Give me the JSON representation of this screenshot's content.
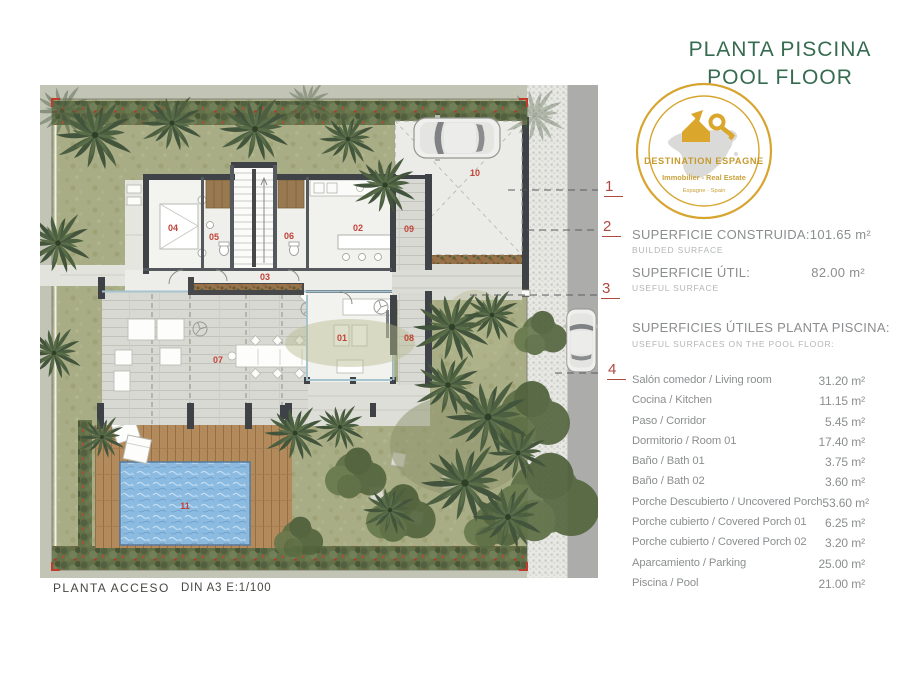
{
  "title": {
    "line1": "PLANTA PISCINA",
    "line2": "POOL FLOOR"
  },
  "logo": {
    "brand": "DESTINATION ESPAGNE",
    "tagline": "Immobilier - Real Estate",
    "subline": "Espagne - Spain"
  },
  "legend": {
    "markers": [
      {
        "n": "1"
      },
      {
        "n": "2"
      },
      {
        "n": "3"
      },
      {
        "n": "4"
      }
    ],
    "built_label": "SUPERFICIE CONSTRUIDA:",
    "built_sublabel": "BUILDED SURFACE",
    "built_value": "101.65 m²",
    "useful_label": "SUPERFICIE ÚTIL:",
    "useful_sublabel": "USEFUL SURFACE",
    "useful_value": "82.00 m²",
    "surfaces_title": "SUPERFICIES ÚTILES PLANTA PISCINA:",
    "surfaces_subtitle": "USEFUL SURFACES ON THE POOL FLOOR:",
    "rows": [
      {
        "label": "Salón comedor / Living room",
        "value": "31.20 m²"
      },
      {
        "label": "Cocina / Kitchen",
        "value": "11.15 m²"
      },
      {
        "label": "Paso / Corridor",
        "value": "5.45 m²"
      },
      {
        "label": "Dormitorio / Room 01",
        "value": "17.40 m²"
      },
      {
        "label": "Baño / Bath 01",
        "value": "3.75 m²"
      },
      {
        "label": "Baño / Bath 02",
        "value": "3.60 m²"
      },
      {
        "label": "Porche Descubierto / Uncovered Porch",
        "value": "53.60 m²"
      },
      {
        "label": "Porche cubierto / Covered Porch 01",
        "value": "6.25 m²"
      },
      {
        "label": "Porche cubierto / Covered Porch 02",
        "value": "3.20 m²"
      },
      {
        "label": "Aparcamiento / Parking",
        "value": "25.00 m²"
      },
      {
        "label": "Piscina / Pool",
        "value": "21.00 m²"
      }
    ]
  },
  "plan": {
    "rooms": {
      "n01": "01",
      "n02": "02",
      "n03": "03",
      "n04": "04",
      "n05": "05",
      "n06": "06",
      "n07": "07",
      "n08": "08",
      "n09": "09",
      "n10": "10",
      "n11": "11"
    }
  },
  "footer": {
    "plan_name": "PLANTA ACCESO",
    "scale": "DIN A3  E:1/100"
  },
  "colors": {
    "title_green": "#376b50",
    "logo_gold": "#d7a52f",
    "marker_red": "#ac4a41",
    "room_number_red": "#c24338",
    "pool_blue": "#8cbbe2",
    "garden_green": "#a9ad86"
  }
}
